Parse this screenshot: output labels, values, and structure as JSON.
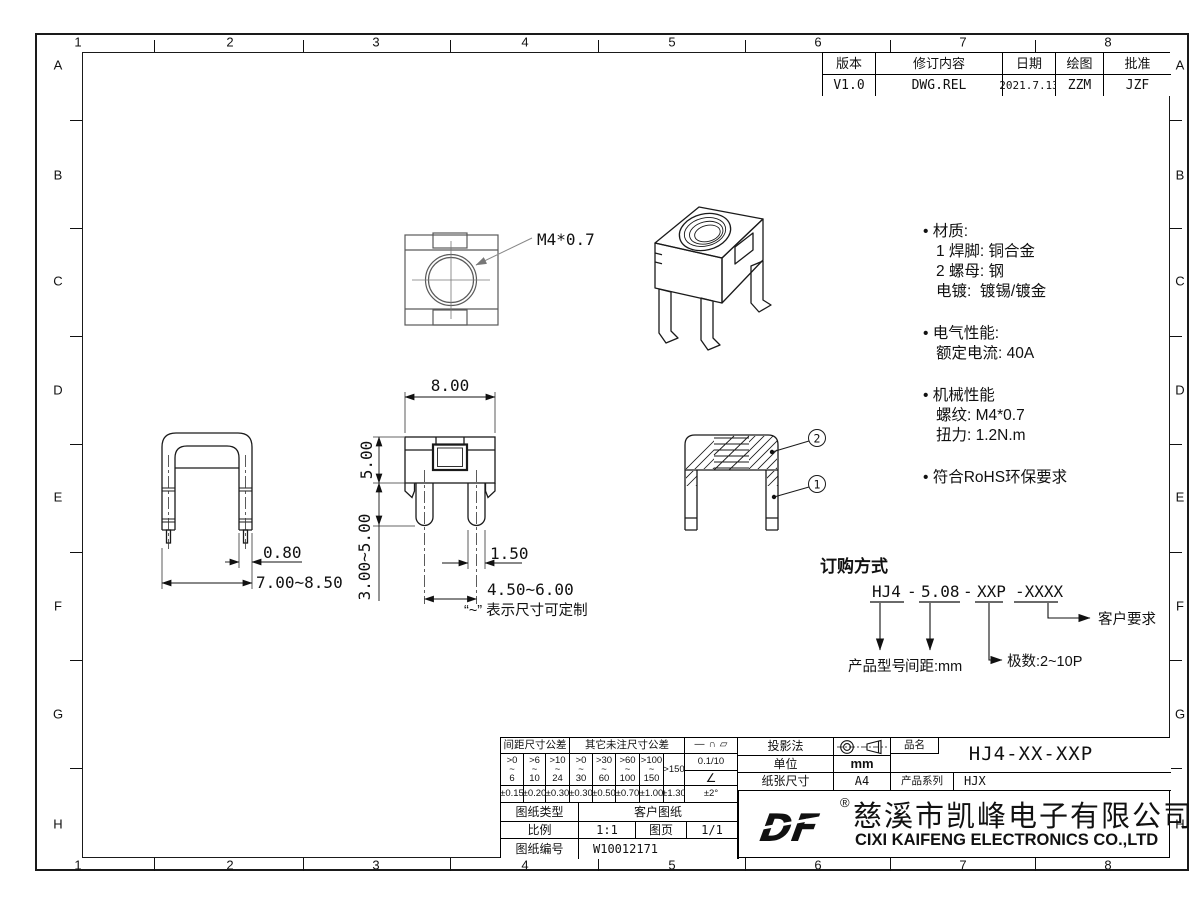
{
  "border": {
    "columns": [
      "1",
      "2",
      "3",
      "4",
      "5",
      "6",
      "7",
      "8"
    ],
    "rows": [
      "A",
      "B",
      "C",
      "D",
      "E",
      "F",
      "G",
      "H"
    ]
  },
  "revision_table": {
    "headers": [
      "版本",
      "修订内容",
      "日期",
      "绘图",
      "批准"
    ],
    "row": [
      "V1.0",
      "DWG.REL",
      "2021.7.13",
      "ZZM",
      "JZF"
    ]
  },
  "notes": {
    "lines": [
      "• 材质:",
      "1 焊脚: 铜合金",
      "2 螺母: 钢",
      "电镀:  镀锡/镀金",
      "• 电气性能:",
      "额定电流: 40A",
      "• 机械性能",
      "螺纹: M4*0.7",
      "扭力: 1.2N.m",
      "• 符合RoHS环保要求"
    ]
  },
  "dimensions": {
    "thread": "M4*0.7",
    "width": "8.00",
    "body_height": "5.00",
    "leg_length": "3.00~5.00",
    "leg_thickness": "0.80",
    "outer_width": "7.00~8.50",
    "pin_width": "1.50",
    "pin_pitch": "4.50~6.00",
    "custom_note": "“~” 表示尺寸可定制",
    "balloon_nut": "2",
    "balloon_pin": "1"
  },
  "ordering": {
    "title": "订购方式",
    "part_model": "HJ4",
    "dash1": "-",
    "part_pitch": "5.08",
    "dash2": "-",
    "part_poles": "XXP",
    "part_suffix": "-XXXX",
    "label_model": "产品型号",
    "label_pitch": "间距:mm",
    "label_poles": "极数:2~10P",
    "label_customer": "客户要求"
  },
  "tolerance_table": {
    "pitch_header": "间距尺寸公差",
    "other_header": "其它未注尺寸公差",
    "tilde": "~",
    "pitch_ranges": [
      {
        "gt": ">0",
        "lim": "6"
      },
      {
        "gt": ">6",
        "lim": "10"
      },
      {
        "gt": ">10",
        "lim": "24"
      }
    ],
    "other_ranges": [
      {
        "gt": ">0",
        "lim": "30"
      },
      {
        "gt": ">30",
        "lim": "60"
      },
      {
        "gt": ">60",
        "lim": "100"
      },
      {
        "gt": ">100",
        "lim": "150"
      }
    ],
    "over": ">150",
    "values": [
      "±0.15",
      "±0.20",
      "±0.30",
      "±0.30",
      "±0.50",
      "±0.70",
      "±1.00",
      "±1.30"
    ],
    "symbols": {
      "straight": "—",
      "arc": "∩",
      "flat": "▱",
      "angle": "∠"
    },
    "flatness": "0.1/10",
    "angle_tol": "±2°"
  },
  "title_block": {
    "projection_label": "投影法",
    "unit_label": "单位",
    "unit_value": "mm",
    "paper_label": "纸张尺寸",
    "paper_value": "A4",
    "name_label": "品名",
    "name_value": "HJ4-XX-XXP",
    "series_label": "产品系列",
    "series_value": "HJX",
    "type_label": "图纸类型",
    "type_value": "客户图纸",
    "scale_label": "比例",
    "scale_value": "1:1",
    "page_label": "图页",
    "page_value": "1/1",
    "number_label": "图纸编号",
    "number_value": "W10012171"
  },
  "company": {
    "logo_text": "DF",
    "reg": "®",
    "name_cn": "慈溪市凯峰电子有限公司",
    "name_en": "CIXI KAIFENG ELECTRONICS CO.,LTD"
  }
}
